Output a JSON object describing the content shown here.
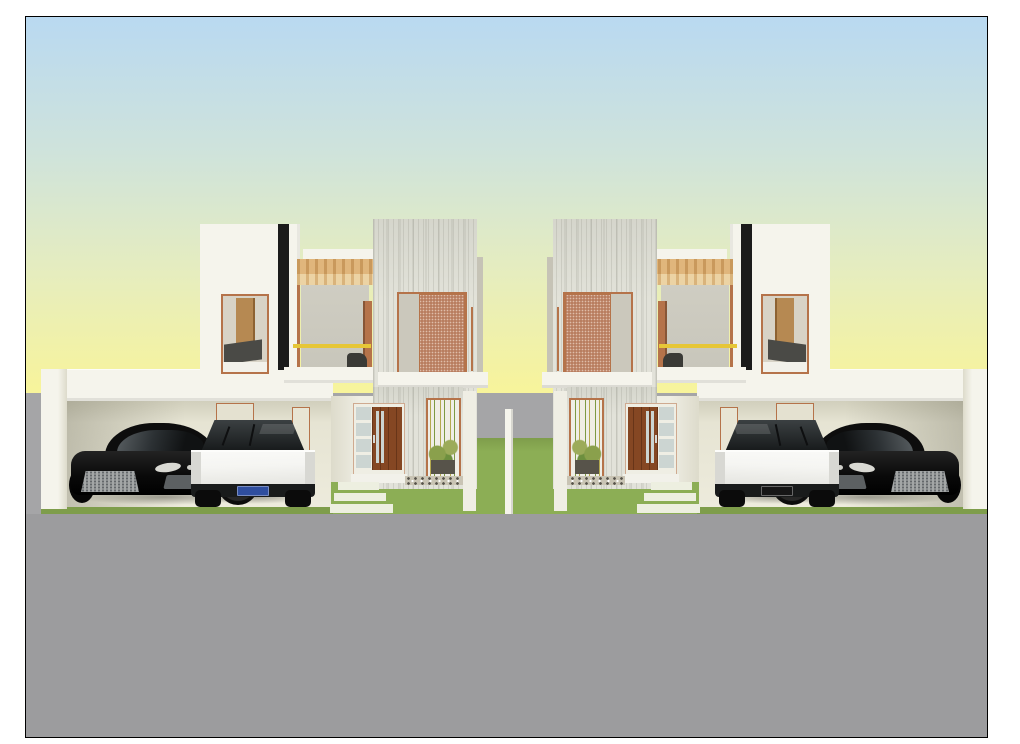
{
  "scene": {
    "type": "3d-architectural-render",
    "description": "Front elevation rendering of two mirrored modern two-storey houses, each with a flat-roof carport sheltering a black sports coupe and a white angular electric pickup, a timber pergola balcony with yellow railing, perforated copper window screens, a timber entry door with frosted sidelight, a bamboo planter window over a pebble bed, lawns with white concrete stepping pads, a grey boundary wall and road, under a blue-to-yellow dawn sky. No readable text is visible; license plates are illegible.",
    "houses": [
      {
        "side": "left",
        "mirrored": false
      },
      {
        "side": "right",
        "mirrored": true
      }
    ],
    "house_features": [
      "white bedroom tower with black accent stripe",
      "copper-framed bedroom window showing wardrobe and dark bed",
      "timber slat pergola over first-floor balcony",
      "yellow balcony railing",
      "board-textured concrete volume with perforated copper screen window",
      "timber entry door with frosted glass sidelight",
      "bamboo planter window with pebble strip",
      "flat-roof double carport with interior door outlines"
    ],
    "vehicles_per_house": [
      {
        "type": "black sports coupe",
        "position": "street side of carport"
      },
      {
        "type": "white angular electric pickup",
        "position": "house side of carport",
        "plate_color_left_house": "#2f4e9e",
        "plate_color_right_house": "#161616"
      }
    ],
    "landscape": [
      "gradient dawn sky",
      "grey boundary wall and foreground road",
      "green lawn between houses",
      "white concrete stepping pads",
      "white property divider wall between lots"
    ],
    "colors": {
      "page_bg": "#ffffff",
      "frame_border": "#000000",
      "sky_top": "#b9d9f1",
      "sky_upper_mid": "#cfe3db",
      "sky_lower_mid": "#e6edbe",
      "sky_bottom": "#f8f49a",
      "backdrop_gray": "#a5a5a7",
      "road_gray": "#9c9c9e",
      "grass": "#8cae55",
      "grass_shade": "#7e9d4b",
      "wall_white": "#f5f4ec",
      "wall_cream": "#efeee4",
      "wall_shadow": "#dddbcb",
      "carport_interior": "#e6e4d3",
      "carport_interior_dark": "#cfcdba",
      "texture_base": "#e2e2d9",
      "tower_black": "#1b1b1b",
      "copper": "#b5734a",
      "mesh": "#b97e60",
      "wood_slat_light": "#e0b67c",
      "wood_slat_dark": "#c9995c",
      "rail_yellow": "#e6c636",
      "balcony_gray": "#c8c6bb",
      "door_wood": "#854723",
      "frosted": "#ccd5d2",
      "plate_blue": "#2f4e9e",
      "plate_black": "#161616",
      "car_black": "#0d0d0d",
      "rim_silver": "#c2c2c2",
      "truck_white": "#f5f5f2",
      "truck_shadow": "#e4e4df",
      "interior_wood": "#b68952",
      "bed_dark": "#4a4a46",
      "sill_white": "#f2f1ea",
      "pebble_bg": "#c9c4b4",
      "bamboo_green": "#7d9a43",
      "bamboo_yellow": "#b3a94f",
      "pad_white": "#edefe0"
    }
  }
}
